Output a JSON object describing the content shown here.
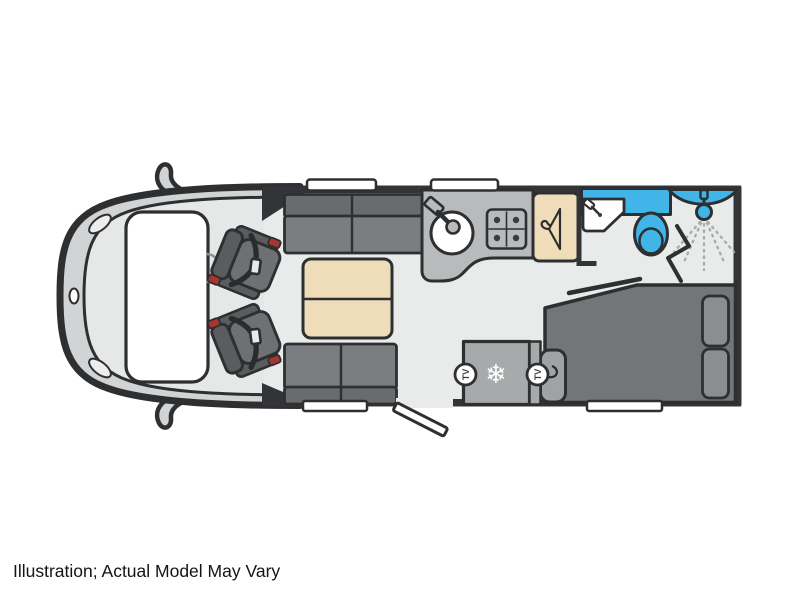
{
  "caption": "Illustration; Actual Model May Vary",
  "labels": {
    "tv_front": "TV",
    "tv_rear": "TV"
  },
  "icons": {
    "snowflake": "❄",
    "hanger": "coat-hanger",
    "shower": "shower-head-with-spray",
    "hob": "four-burner-hob",
    "sink": "round-sink-with-tap"
  },
  "colors": {
    "line": "#2e2f31",
    "wall": "#333437",
    "floor": "#e9eaea",
    "cab-band": "#d2d3d4",
    "cab-inner": "#e6e7e7",
    "sofa-seat": "#7b7d80",
    "sofa-back": "#696b6e",
    "table-beige": "#efddba",
    "counter-gray": "#b9babc",
    "fridge-gray": "#a7a9ab",
    "bed-gray": "#737577",
    "pillow-gray": "#8b8d90",
    "step-gray": "#a0a2a4",
    "fixture-blue": "#41b4e8",
    "seat-dark": "#5a5c5f",
    "seat-mid": "#6e7073",
    "seat-red": "#a93531"
  }
}
